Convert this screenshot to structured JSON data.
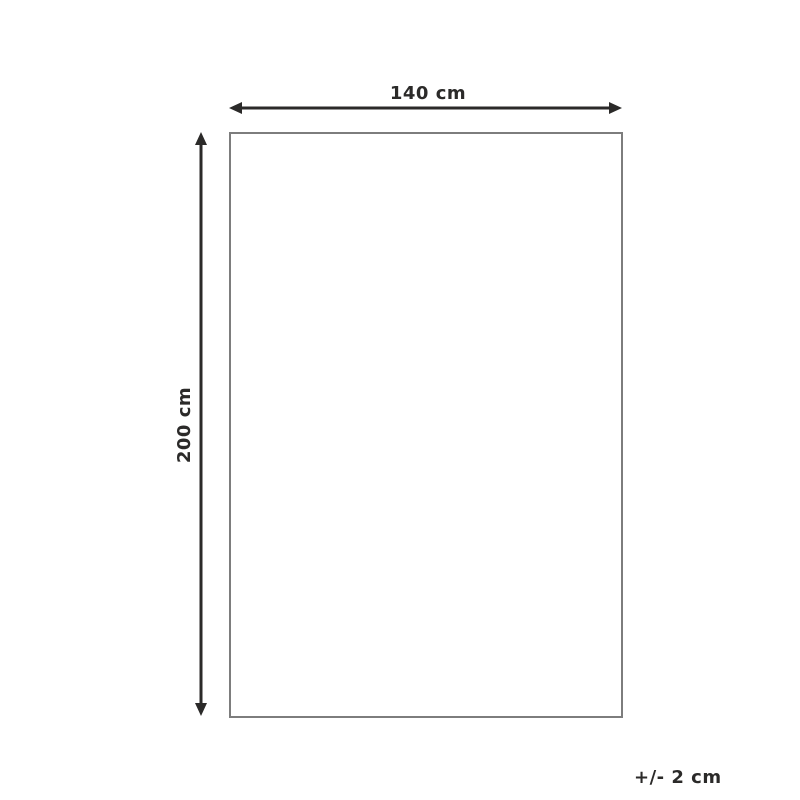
{
  "diagram": {
    "type": "product-dimension-diagram",
    "width_label": "140 cm",
    "height_label": "200 cm",
    "tolerance_label": "+/- 2 cm",
    "colors": {
      "background": "#ffffff",
      "arrow": "#2b2a29",
      "text": "#2b2a29",
      "outline": "#7d7d7d"
    }
  }
}
